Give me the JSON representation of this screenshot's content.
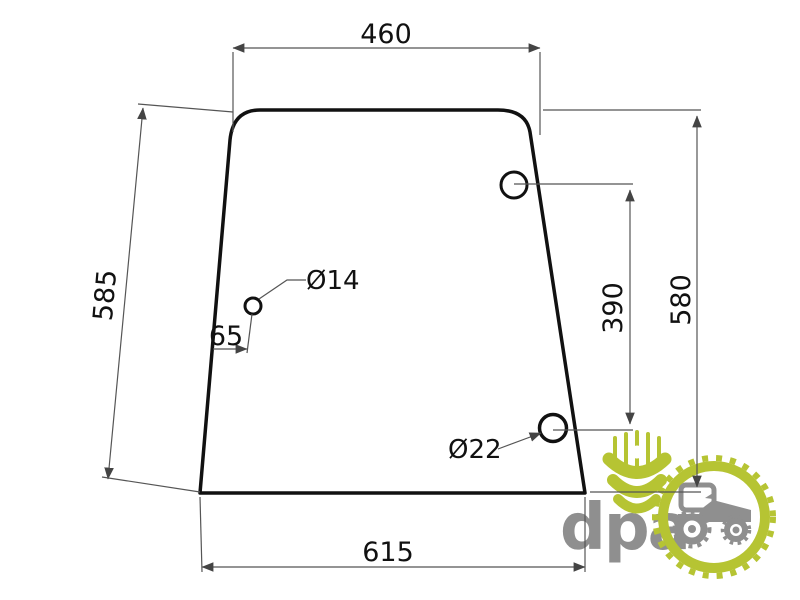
{
  "drawing": {
    "type": "technical-dimension-drawing",
    "part": "trapezoidal glass panel with three holes",
    "dimensions": {
      "top_width": "460",
      "left_slant_height": "585",
      "small_hole_offset": "65",
      "small_hole_diameter": "Ø14",
      "hole_vertical_spacing": "390",
      "right_height": "580",
      "large_hole_diameter": "Ø22",
      "bottom_width": "615"
    },
    "colors": {
      "outline": "#111111",
      "dimension_line": "#555555",
      "background": "#ffffff"
    }
  },
  "logo": {
    "text": "dpa",
    "icons": [
      "wheat-icon",
      "gear-ring-icon",
      "tractor-icon"
    ],
    "colors": {
      "green": "#b6c433",
      "gray": "#8f8f8f"
    }
  }
}
